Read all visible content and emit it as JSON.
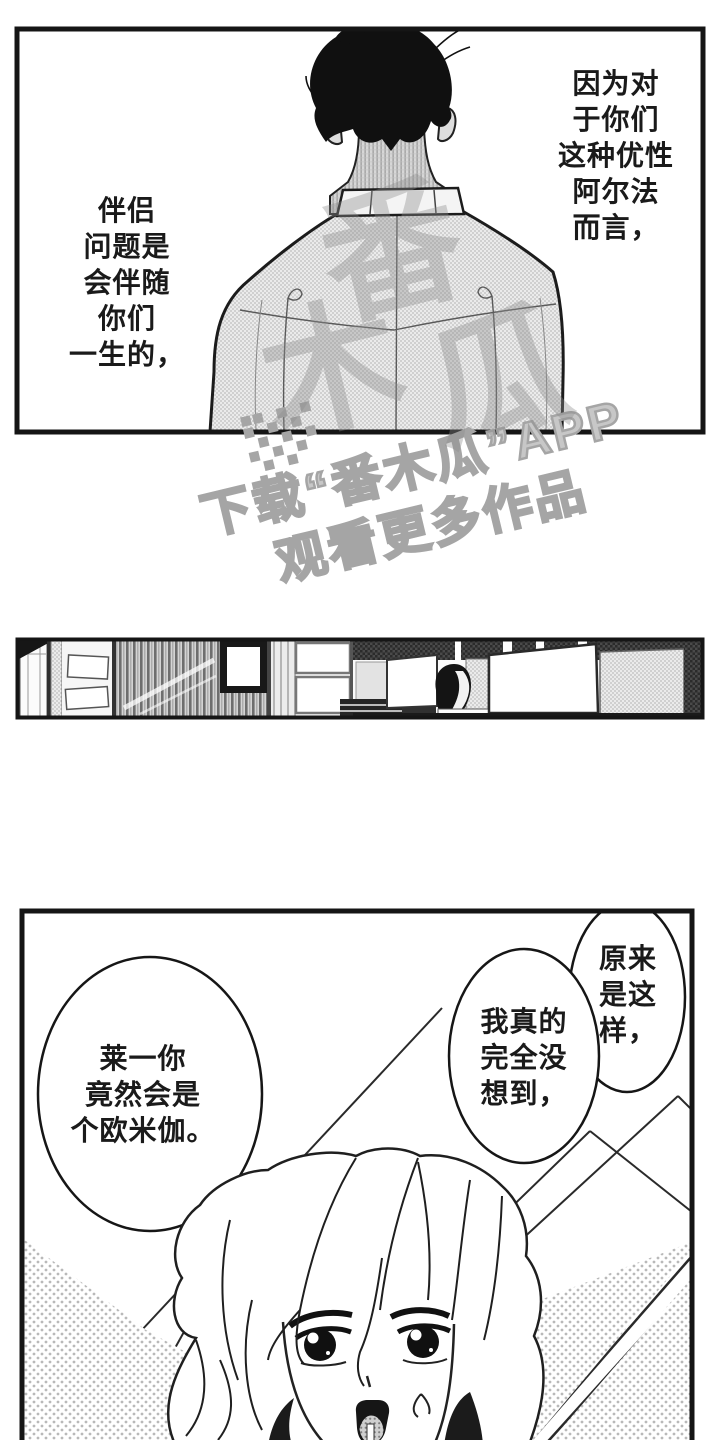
{
  "colors": {
    "paper": "#ffffff",
    "ink": "#1a1a1a",
    "watermark_gray": "#a5a5a5",
    "tone_gray": "#bdbdbd"
  },
  "panel_top": {
    "narration_left": {
      "lines": [
        "伴侣",
        "问题是",
        "会伴随",
        "你们",
        "一生的，"
      ]
    },
    "narration_right": {
      "lines": [
        "因为对",
        "于你们",
        "这种优性",
        "阿尔法",
        "而言，"
      ]
    }
  },
  "watermark": {
    "logo_icon": "papaya-grid-logo",
    "line1": "下载“番木瓜”APP",
    "line2": "观看更多作品",
    "shirt_mark_chars": [
      "番",
      "木",
      "瓜"
    ]
  },
  "panel_bottom": {
    "bubble_top_right": {
      "lines": [
        "原来",
        "是这",
        "样，"
      ]
    },
    "bubble_middle": {
      "lines": [
        "我真的",
        "完全没",
        "想到，"
      ]
    },
    "bubble_left": {
      "lines": [
        "莱一你",
        "竟然会是",
        "个欧米伽。"
      ]
    }
  }
}
